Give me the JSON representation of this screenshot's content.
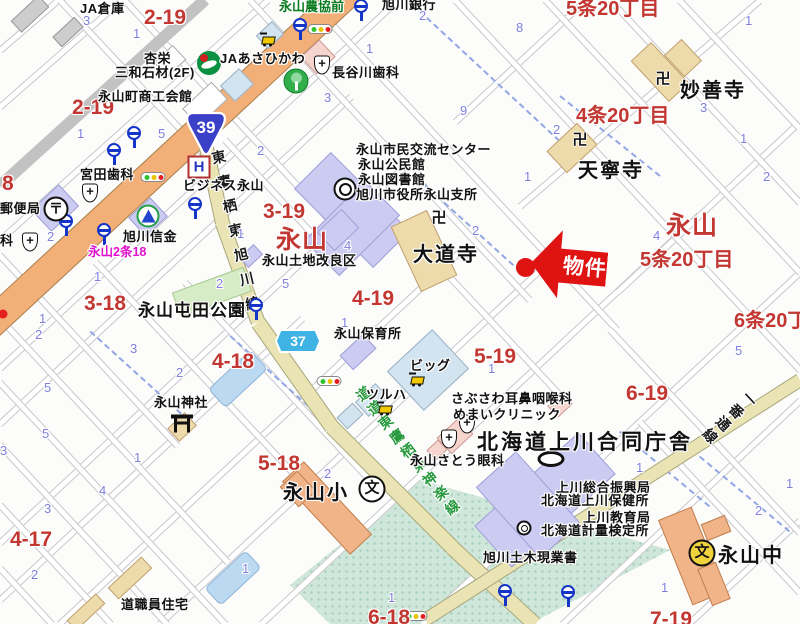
{
  "colors": {
    "red_label": "#c23732",
    "blue_number": "#8080dc",
    "magenta_label": "#e011cc",
    "green_label": "#0a7a1e",
    "green_road_label": "#2a9a40",
    "marker_red": "#e01313",
    "major_road": "#f2b078",
    "pref_road": "#eae3b4",
    "public_building": "#ccccf2",
    "temple_building": "#eedbac",
    "school_building": "#f0b488",
    "open_area": "#cfe7da"
  },
  "marker": {
    "label": "物件"
  },
  "route_shields": {
    "national": {
      "number": "39"
    },
    "prefectural": {
      "number": "37"
    }
  },
  "labels": [
    {
      "t": "2-19",
      "x": 144,
      "y": 6,
      "s": "red"
    },
    {
      "t": "2-19",
      "x": 72,
      "y": 96,
      "s": "red"
    },
    {
      "t": "8",
      "x": 2,
      "y": 172,
      "s": "red"
    },
    {
      "t": "3-19",
      "x": 263,
      "y": 200,
      "s": "red"
    },
    {
      "t": "永山",
      "x": 276,
      "y": 220,
      "s": "redxl"
    },
    {
      "t": "3-18",
      "x": 84,
      "y": 292,
      "s": "red"
    },
    {
      "t": "4-19",
      "x": 352,
      "y": 287,
      "s": "red"
    },
    {
      "t": "4-18",
      "x": 212,
      "y": 350,
      "s": "red"
    },
    {
      "t": "5-19",
      "x": 474,
      "y": 345,
      "s": "red"
    },
    {
      "t": "5-18",
      "x": 258,
      "y": 452,
      "s": "red"
    },
    {
      "t": "4-17",
      "x": 10,
      "y": 528,
      "s": "red"
    },
    {
      "t": "6-19",
      "x": 626,
      "y": 382,
      "s": "red"
    },
    {
      "t": "6-18",
      "x": 368,
      "y": 606,
      "s": "red"
    },
    {
      "t": "7-19",
      "x": 650,
      "y": 608,
      "s": "red"
    },
    {
      "t": "5条20丁目",
      "x": 566,
      "y": -8,
      "s": "redmd"
    },
    {
      "t": "4条20丁目",
      "x": 576,
      "y": 99,
      "s": "redmd"
    },
    {
      "t": "永山",
      "x": 666,
      "y": 206,
      "s": "redxl"
    },
    {
      "t": "5条20丁目",
      "x": 640,
      "y": 243,
      "s": "redmd"
    },
    {
      "t": "6条20丁目",
      "x": 734,
      "y": 304,
      "s": "redmd"
    },
    {
      "t": "JA倉庫",
      "x": 80,
      "y": -2,
      "s": "bk"
    },
    {
      "t": "旭川銀行",
      "x": 382,
      "y": -6,
      "s": "bk"
    },
    {
      "t": "永山農協前",
      "x": 279,
      "y": -4,
      "s": "grn"
    },
    {
      "t": "杏栄",
      "x": 144,
      "y": 48,
      "s": "bk"
    },
    {
      "t": "三和石材(2F)",
      "x": 115,
      "y": 62,
      "s": "bk"
    },
    {
      "t": "JAあさひかわ",
      "x": 220,
      "y": 48,
      "s": "bk"
    },
    {
      "t": "長谷川歯科",
      "x": 332,
      "y": 62,
      "s": "bk"
    },
    {
      "t": "永山町商工会館",
      "x": 98,
      "y": 86,
      "s": "bk"
    },
    {
      "t": "宮田歯科",
      "x": 80,
      "y": 164,
      "s": "bk"
    },
    {
      "t": "ビジネス永山",
      "x": 183,
      "y": 175,
      "s": "bk"
    },
    {
      "t": "郵便局",
      "x": 0,
      "y": 198,
      "s": "bk"
    },
    {
      "t": "科",
      "x": 0,
      "y": 230,
      "s": "bk"
    },
    {
      "t": "旭川信金",
      "x": 123,
      "y": 226,
      "s": "bk"
    },
    {
      "t": "永山2条18",
      "x": 88,
      "y": 241,
      "s": "mag"
    },
    {
      "t": "永山市民交流センター",
      "x": 356,
      "y": 139,
      "s": "bk"
    },
    {
      "t": "永山公民館",
      "x": 358,
      "y": 154,
      "s": "bk"
    },
    {
      "t": "永山図書館",
      "x": 358,
      "y": 169,
      "s": "bk"
    },
    {
      "t": "旭川市役所永山支所",
      "x": 356,
      "y": 184,
      "s": "bk"
    },
    {
      "t": "妙善寺",
      "x": 680,
      "y": 74,
      "s": "blg"
    },
    {
      "t": "天寧寺",
      "x": 578,
      "y": 154,
      "s": "blg"
    },
    {
      "t": "大道寺",
      "x": 413,
      "y": 238,
      "s": "blg"
    },
    {
      "t": "永山土地改良区",
      "x": 262,
      "y": 250,
      "s": "bk"
    },
    {
      "t": "永山屯田公園",
      "x": 138,
      "y": 296,
      "s": "bmd"
    },
    {
      "t": "永山保育所",
      "x": 334,
      "y": 323,
      "s": "bk"
    },
    {
      "t": "ビッグ",
      "x": 410,
      "y": 355,
      "s": "bk"
    },
    {
      "t": "ツルハ",
      "x": 366,
      "y": 384,
      "s": "bk"
    },
    {
      "t": "さぶさわ耳鼻咽喉科",
      "x": 451,
      "y": 388,
      "s": "bk"
    },
    {
      "t": "めまいクリニック",
      "x": 453,
      "y": 404,
      "s": "bk"
    },
    {
      "t": "永山さとう眼科",
      "x": 410,
      "y": 450,
      "s": "bk"
    },
    {
      "t": "北海道上川合同庁舎",
      "x": 477,
      "y": 426,
      "s": "blg20"
    },
    {
      "t": "上川総合振興局",
      "x": 556,
      "y": 477,
      "s": "bk"
    },
    {
      "t": "北海道上川保健所",
      "x": 541,
      "y": 490,
      "s": "bk"
    },
    {
      "t": "上川教育局",
      "x": 583,
      "y": 507,
      "s": "bk"
    },
    {
      "t": "北海道計量検定所",
      "x": 541,
      "y": 520,
      "s": "bk"
    },
    {
      "t": "旭川土木現業書",
      "x": 483,
      "y": 547,
      "s": "bk"
    },
    {
      "t": "永山神社",
      "x": 154,
      "y": 392,
      "s": "bk"
    },
    {
      "t": "永山小",
      "x": 283,
      "y": 476,
      "s": "blg"
    },
    {
      "t": "道職員住宅",
      "x": 121,
      "y": 594,
      "s": "bk"
    },
    {
      "t": "永山中",
      "x": 718,
      "y": 539,
      "s": "blg"
    }
  ],
  "road_labels": [
    {
      "t": "東鷹栖東旭川線",
      "x": 207,
      "y": 150,
      "rot": -13,
      "c": "#1a1a1a",
      "ls": 11
    },
    {
      "t": "道道東鷹栖東神楽線",
      "x": 349,
      "y": 388,
      "rot": -38,
      "c": "#2a9a40",
      "ls": 4
    },
    {
      "t": "一番通線",
      "x": 745,
      "y": 394,
      "rot": 47,
      "c": "#1a1a1a",
      "ls": 4
    }
  ],
  "block_numbers": [
    [
      83,
      13,
      "3"
    ],
    [
      133,
      26,
      "1"
    ],
    [
      419,
      8,
      "2"
    ],
    [
      516,
      20,
      "8"
    ],
    [
      745,
      13,
      "1"
    ],
    [
      366,
      41,
      "1"
    ],
    [
      324,
      90,
      "3"
    ],
    [
      460,
      103,
      "9"
    ],
    [
      553,
      122,
      "2"
    ],
    [
      700,
      100,
      "3"
    ],
    [
      740,
      131,
      "1"
    ],
    [
      524,
      169,
      "1"
    ],
    [
      763,
      169,
      "2"
    ],
    [
      77,
      126,
      "1"
    ],
    [
      158,
      126,
      "5"
    ],
    [
      257,
      143,
      "2"
    ],
    [
      47,
      229,
      "2"
    ],
    [
      94,
      269,
      "1"
    ],
    [
      39,
      311,
      "1"
    ],
    [
      237,
      226,
      "1"
    ],
    [
      216,
      276,
      "2"
    ],
    [
      282,
      276,
      "5"
    ],
    [
      344,
      238,
      "4"
    ],
    [
      341,
      315,
      "1"
    ],
    [
      130,
      341,
      "3"
    ],
    [
      44,
      380,
      "5"
    ],
    [
      176,
      365,
      "2"
    ],
    [
      35,
      327,
      "2"
    ],
    [
      42,
      426,
      "5"
    ],
    [
      134,
      450,
      "1"
    ],
    [
      99,
      483,
      "4"
    ],
    [
      44,
      501,
      "3"
    ],
    [
      31,
      567,
      "2"
    ],
    [
      0,
      443,
      "3"
    ],
    [
      324,
      466,
      "2"
    ],
    [
      242,
      561,
      "1"
    ],
    [
      388,
      590,
      "1"
    ],
    [
      636,
      460,
      "1"
    ],
    [
      786,
      476,
      "1"
    ],
    [
      755,
      503,
      "2"
    ],
    [
      661,
      580,
      "1"
    ],
    [
      735,
      343,
      "5"
    ],
    [
      472,
      223,
      "2"
    ],
    [
      488,
      361,
      "1"
    ],
    [
      653,
      228,
      "4"
    ]
  ],
  "streets": [
    [
      0,
      50,
      58,
      0
    ],
    [
      0,
      107,
      122,
      0
    ],
    [
      0,
      240,
      268,
      0
    ],
    [
      0,
      368,
      398,
      0
    ],
    [
      0,
      424,
      352,
      96
    ],
    [
      0,
      543,
      430,
      143
    ],
    [
      0,
      600,
      302,
      319
    ],
    [
      60,
      624,
      462,
      250
    ],
    [
      160,
      624,
      562,
      250
    ],
    [
      262,
      624,
      700,
      215
    ],
    [
      422,
      624,
      800,
      272
    ],
    [
      562,
      624,
      800,
      400
    ],
    [
      455,
      122,
      586,
      0
    ],
    [
      520,
      206,
      760,
      0
    ],
    [
      618,
      292,
      800,
      122
    ],
    [
      688,
      624,
      800,
      520
    ],
    [
      60,
      0,
      215,
      166
    ],
    [
      125,
      0,
      330,
      220
    ],
    [
      250,
      0,
      530,
      300
    ],
    [
      310,
      0,
      618,
      330
    ],
    [
      455,
      0,
      800,
      370
    ],
    [
      545,
      0,
      800,
      273
    ],
    [
      610,
      0,
      800,
      203
    ],
    [
      680,
      0,
      800,
      128
    ],
    [
      0,
      255,
      178,
      446
    ],
    [
      0,
      318,
      228,
      562
    ],
    [
      0,
      382,
      226,
      624
    ],
    [
      0,
      445,
      167,
      624
    ],
    [
      0,
      505,
      111,
      624
    ],
    [
      0,
      568,
      52,
      624
    ],
    [
      95,
      262,
      330,
      513
    ],
    [
      185,
      282,
      370,
      480
    ],
    [
      430,
      255,
      570,
      405
    ],
    [
      610,
      330,
      800,
      533
    ],
    [
      640,
      422,
      800,
      593
    ],
    [
      225,
      140,
      332,
      255
    ]
  ],
  "boundaries": [
    [
      90,
      330,
      195,
      425
    ],
    [
      230,
      335,
      330,
      425
    ],
    [
      560,
      95,
      660,
      175
    ],
    [
      415,
      175,
      520,
      270
    ],
    [
      620,
      430,
      710,
      505
    ],
    [
      700,
      455,
      790,
      530
    ],
    [
      420,
      10,
      560,
      140
    ]
  ],
  "roads": [
    {
      "p": [
        -40,
        352,
        370,
        -28
      ],
      "w": 30,
      "c": "road-orange"
    },
    {
      "p": [
        0,
        186,
        205,
        0
      ],
      "w": 12,
      "c": "road-rail"
    },
    {
      "p": [
        196,
        100,
        222,
        222
      ],
      "w": 15,
      "c": "road-pref"
    },
    {
      "p": [
        222,
        222,
        258,
        322
      ],
      "w": 15,
      "c": "road-pref"
    },
    {
      "p": [
        258,
        322,
        332,
        427
      ],
      "w": 16,
      "c": "road-pref"
    },
    {
      "p": [
        332,
        427,
        452,
        547
      ],
      "w": 16,
      "c": "road-pref"
    },
    {
      "p": [
        452,
        547,
        535,
        624
      ],
      "w": 16,
      "c": "road-pref"
    },
    {
      "p": [
        800,
        380,
        425,
        620
      ],
      "w": 14,
      "c": "road-pref"
    }
  ],
  "buildings": [
    {
      "x": 352,
      "y": 210,
      "w": 52,
      "h": 112,
      "r": -45,
      "c": "lav"
    },
    {
      "x": 352,
      "y": 228,
      "w": 50,
      "h": 86,
      "r": 45,
      "c": "lav"
    },
    {
      "x": 545,
      "y": 500,
      "w": 56,
      "h": 140,
      "r": 48,
      "c": "lav"
    },
    {
      "x": 528,
      "y": 505,
      "w": 54,
      "h": 96,
      "r": -42,
      "c": "lav"
    },
    {
      "x": 358,
      "y": 352,
      "w": 32,
      "h": 20,
      "r": -43,
      "c": "lav"
    },
    {
      "x": 148,
      "y": 217,
      "w": 30,
      "h": 26,
      "r": -43,
      "c": "lav"
    },
    {
      "x": 55,
      "y": 208,
      "w": 38,
      "h": 30,
      "r": -43,
      "c": "lav"
    },
    {
      "x": 251,
      "y": 256,
      "w": 20,
      "h": 14,
      "r": -43,
      "c": "lav"
    },
    {
      "x": 338,
      "y": 230,
      "w": 34,
      "h": 26,
      "r": -43,
      "c": "lav"
    },
    {
      "x": 660,
      "y": 72,
      "w": 56,
      "h": 28,
      "r": 47,
      "c": "tan"
    },
    {
      "x": 683,
      "y": 58,
      "w": 24,
      "h": 30,
      "r": -43,
      "c": "tan"
    },
    {
      "x": 572,
      "y": 148,
      "w": 42,
      "h": 30,
      "r": -43,
      "c": "tan"
    },
    {
      "x": 424,
      "y": 251,
      "w": 40,
      "h": 72,
      "r": -25,
      "c": "tan"
    },
    {
      "x": 182,
      "y": 427,
      "w": 24,
      "h": 18,
      "r": -43,
      "c": "tan"
    },
    {
      "x": 130,
      "y": 578,
      "w": 46,
      "h": 16,
      "r": -43,
      "c": "tan"
    },
    {
      "x": 86,
      "y": 612,
      "w": 40,
      "h": 14,
      "r": -43,
      "c": "tan"
    },
    {
      "x": 30,
      "y": 14,
      "w": 38,
      "h": 16,
      "r": -43,
      "c": "gry"
    },
    {
      "x": 68,
      "y": 32,
      "w": 30,
      "h": 14,
      "r": -43,
      "c": "gry"
    },
    {
      "x": 237,
      "y": 85,
      "w": 26,
      "h": 22,
      "r": -43,
      "c": "ltb"
    },
    {
      "x": 428,
      "y": 370,
      "w": 62,
      "h": 54,
      "r": -43,
      "c": "ltb"
    },
    {
      "x": 372,
      "y": 400,
      "w": 28,
      "h": 20,
      "r": -43,
      "c": "ltb"
    },
    {
      "x": 350,
      "y": 416,
      "w": 22,
      "h": 16,
      "r": -43,
      "c": "ltb"
    },
    {
      "x": 270,
      "y": 35,
      "w": 22,
      "h": 18,
      "r": -43,
      "c": "ltb"
    },
    {
      "x": 318,
      "y": 57,
      "w": 26,
      "h": 24,
      "r": -43,
      "c": "pnk"
    },
    {
      "x": 455,
      "y": 436,
      "w": 30,
      "h": 22,
      "r": -43,
      "c": "pnk"
    },
    {
      "x": 437,
      "y": 450,
      "w": 16,
      "h": 14,
      "r": -43,
      "c": "pnk"
    },
    {
      "x": 560,
      "y": 405,
      "w": 20,
      "h": 16,
      "r": -43,
      "c": "pnk"
    },
    {
      "x": 327,
      "y": 508,
      "w": 100,
      "h": 30,
      "r": 47,
      "c": "org"
    },
    {
      "x": 298,
      "y": 489,
      "w": 28,
      "h": 24,
      "r": 47,
      "c": "org"
    },
    {
      "x": 692,
      "y": 556,
      "w": 36,
      "h": 92,
      "r": -22,
      "c": "org"
    },
    {
      "x": 714,
      "y": 584,
      "w": 40,
      "h": 20,
      "r": 68,
      "c": "org"
    },
    {
      "x": 716,
      "y": 528,
      "w": 26,
      "h": 18,
      "r": -22,
      "c": "org"
    },
    {
      "x": 205,
      "y": 104,
      "w": 40,
      "h": 24,
      "r": -43,
      "c": "wht"
    },
    {
      "x": 170,
      "y": 61,
      "w": 26,
      "h": 20,
      "r": -43,
      "c": "wht"
    },
    {
      "x": 212,
      "y": 292,
      "w": 76,
      "h": 26,
      "r": -20,
      "c": "park"
    },
    {
      "x": 238,
      "y": 379,
      "w": 58,
      "h": 26,
      "r": -43,
      "c": "pond"
    },
    {
      "x": 233,
      "y": 578,
      "w": 56,
      "h": 24,
      "r": -43,
      "c": "pond"
    }
  ],
  "icons": [
    {
      "t": "bus-stop",
      "x": 300,
      "y": 25
    },
    {
      "t": "bus-stop",
      "x": 361,
      "y": 6
    },
    {
      "t": "bus-stop",
      "x": 134,
      "y": 133
    },
    {
      "t": "bus-stop",
      "x": 114,
      "y": 150
    },
    {
      "t": "bus-stop",
      "x": 66,
      "y": 221
    },
    {
      "t": "bus-stop",
      "x": 104,
      "y": 230
    },
    {
      "t": "bus-stop",
      "x": 195,
      "y": 204
    },
    {
      "t": "bus-stop",
      "x": 256,
      "y": 305
    },
    {
      "t": "bus-stop",
      "x": 505,
      "y": 591
    },
    {
      "t": "bus-stop",
      "x": 568,
      "y": 592
    },
    {
      "t": "traffic-light",
      "x": 320,
      "y": 29
    },
    {
      "t": "traffic-light",
      "x": 153,
      "y": 177
    },
    {
      "t": "traffic-light",
      "x": 329,
      "y": 381
    },
    {
      "t": "traffic-light",
      "x": 415,
      "y": 616
    },
    {
      "t": "signal-dot",
      "x": 3,
      "y": 314
    },
    {
      "t": "post-office",
      "x": 56,
      "y": 209
    },
    {
      "t": "hospital",
      "x": 90,
      "y": 193
    },
    {
      "t": "hospital",
      "x": 30,
      "y": 242
    },
    {
      "t": "hospital",
      "x": 322,
      "y": 65
    },
    {
      "t": "hospital",
      "x": 449,
      "y": 439
    },
    {
      "t": "hospital",
      "x": 467,
      "y": 424
    },
    {
      "t": "temple",
      "x": 663,
      "y": 79
    },
    {
      "t": "temple",
      "x": 580,
      "y": 140
    },
    {
      "t": "temple",
      "x": 439,
      "y": 218
    },
    {
      "t": "shrine",
      "x": 182,
      "y": 424
    },
    {
      "t": "school-elem",
      "x": 372,
      "y": 489
    },
    {
      "t": "school-jr",
      "x": 702,
      "y": 553
    },
    {
      "t": "hotel",
      "x": 199,
      "y": 167
    },
    {
      "t": "city-office",
      "x": 345,
      "y": 189
    },
    {
      "t": "gov-building",
      "x": 551,
      "y": 459
    },
    {
      "t": "gov-small",
      "x": 524,
      "y": 528
    },
    {
      "t": "ja-bank",
      "x": 209,
      "y": 63
    },
    {
      "t": "greenery",
      "x": 296,
      "y": 81
    },
    {
      "t": "shinkin-bank",
      "x": 148,
      "y": 216
    },
    {
      "t": "shop-cart",
      "x": 268,
      "y": 40
    },
    {
      "t": "shop-cart",
      "x": 417,
      "y": 380
    },
    {
      "t": "shop-cart",
      "x": 385,
      "y": 409
    }
  ]
}
